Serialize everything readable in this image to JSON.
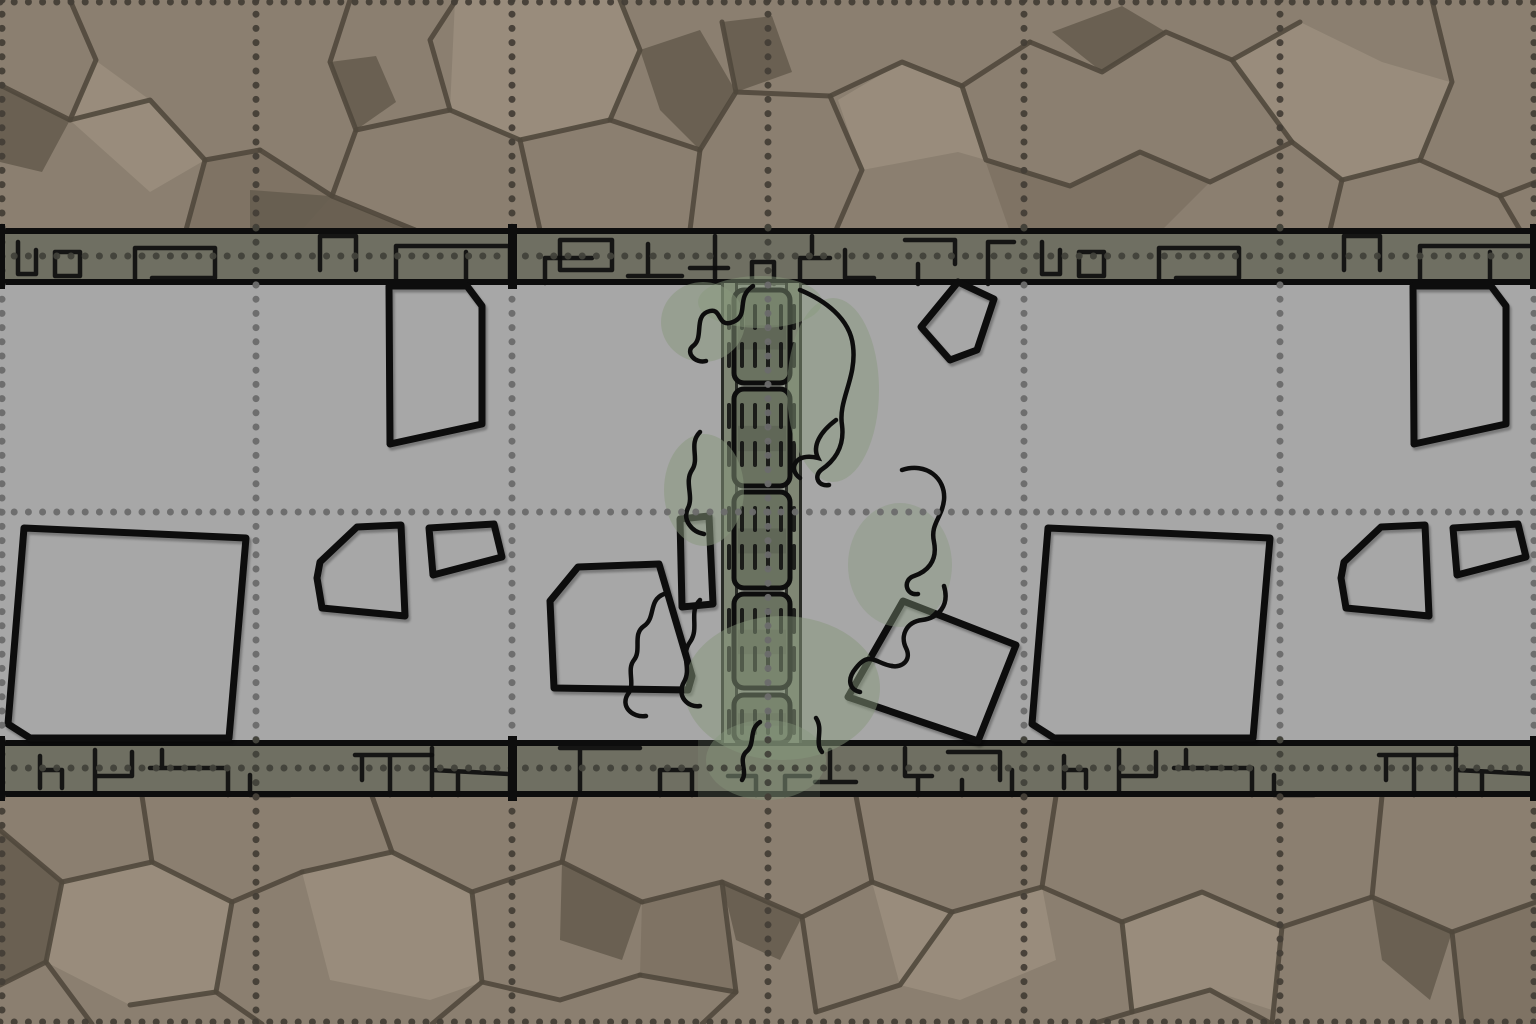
{
  "scene": {
    "width": 1536,
    "height": 1024,
    "module_width": 1024,
    "module_offsets": [
      0,
      1024
    ],
    "colors": {
      "floor": "#a7a7a7",
      "rock_base": "#8b7f70",
      "rock_light": "#9a8e7d",
      "rock_mid": "#7d7263",
      "rock_dark": "#665d4f",
      "crack": "#50483c",
      "wall_fill": "#6f6f62",
      "ink": "#0d0d0d",
      "grid_rock": "#453f37",
      "grid_wall": "#42423a",
      "grid_floor": "#6c6c6c",
      "bridge_rail": "#7f8674",
      "bridge_deck": "#6a7260",
      "bridge_deck_dark": "#5a6152",
      "moss": "#87987c"
    },
    "layout": {
      "rock_top": {
        "y": 0,
        "h": 232
      },
      "rock_bottom": {
        "y": 794,
        "h": 230
      },
      "floor": {
        "y": 285,
        "h": 455
      },
      "wall_top": {
        "y": 228,
        "h": 57
      },
      "wall_bottom": {
        "y": 740,
        "h": 57
      },
      "wall_border_h": 6
    },
    "grid": {
      "cell": 256,
      "dot_step": 14.2,
      "dot_size": 7,
      "v_lines": [
        2,
        256,
        512,
        768,
        1024,
        1280,
        1534
      ],
      "h_lines": [
        2,
        256,
        512,
        768,
        1022
      ]
    },
    "seams": {
      "wall_bars_x": [
        0,
        508,
        1530
      ],
      "bar_w": [
        5,
        9,
        6
      ]
    },
    "rock_top_band": {
      "patches": [
        {
          "fill": "rock_light",
          "pts": "95,60 150,100 205,160 150,192 72,122"
        },
        {
          "fill": "rock_light",
          "pts": "455,0 450,110 520,140 610,120 640,50 622,0"
        },
        {
          "fill": "rock_light",
          "pts": "838,100 862,170 958,152 986,160 962,86 902,62"
        },
        {
          "fill": "rock_light",
          "pts": "1232,60 1300,22 1382,62 1450,82 1420,160 1342,180 1292,142"
        },
        {
          "fill": "rock_dark",
          "pts": "0,85 70,120 42,172 0,162"
        },
        {
          "fill": "rock_dark",
          "pts": "330,62 356,130 396,102 376,56"
        },
        {
          "fill": "rock_dark",
          "pts": "722,22 736,92 792,72 772,16"
        },
        {
          "fill": "rock_dark",
          "pts": "1052,32 1102,72 1166,32 1122,6"
        },
        {
          "fill": "rock_mid",
          "pts": "205,160 260,152 332,196 300,232 186,232"
        },
        {
          "fill": "rock_mid",
          "pts": "985,160 1070,186 1140,152 1210,182 1160,232 1010,232"
        },
        {
          "fill": "rock_dark",
          "pts": "640,50 700,30 735,90 700,150 660,110"
        },
        {
          "fill": "rock_dark",
          "pts": "250,190 330,196 415,232 250,232"
        }
      ],
      "cracks": [
        "M0,85 L70,120 L150,100 L205,160 L260,150",
        "M70,0 L96,60 L70,120",
        "M205,160 L186,230",
        "M260,150 L332,196 L415,230",
        "M332,196 L356,130 L330,62 L350,0",
        "M356,130 L450,110 L520,140 L610,120 L700,150",
        "M450,110 L430,40 L456,0",
        "M520,140 L540,230",
        "M610,120 L640,50 L620,0",
        "M700,150 L736,92 L722,22",
        "M700,150 L690,230",
        "M736,92 L830,96 L902,62 L962,86 L1030,42",
        "M830,96 L862,170 L836,230",
        "M962,86 L986,160 L1070,186 L1140,152 L1210,182 L1292,142",
        "M1030,42 L1102,72 L1166,32 L1232,60 L1300,22",
        "M1292,142 L1342,180 L1420,160 L1500,196 L1536,182",
        "M1420,160 L1452,82 L1432,0",
        "M1342,180 L1330,230",
        "M1500,196 L1520,230",
        "M1232,60 L1292,142"
      ]
    },
    "rock_bottom_band": {
      "patches": [
        {
          "fill": "rock_light",
          "pts": "62,882 152,862 232,902 216,992 130,1005 46,962"
        },
        {
          "fill": "rock_light",
          "pts": "392,852 472,892 482,982 430,1000 330,980 302,872"
        },
        {
          "fill": "rock_light",
          "pts": "872,882 952,912 1042,887 1056,960 960,1000 900,985"
        },
        {
          "fill": "rock_light",
          "pts": "1202,892 1282,927 1272,1010 1210,990 1132,1012 1122,922"
        },
        {
          "fill": "rock_dark",
          "pts": "0,830 62,882 46,962 0,985"
        },
        {
          "fill": "rock_dark",
          "pts": "562,862 642,902 622,960 560,940"
        },
        {
          "fill": "rock_dark",
          "pts": "722,882 802,917 780,960 736,940"
        },
        {
          "fill": "rock_dark",
          "pts": "1372,897 1452,932 1430,1000 1382,960"
        },
        {
          "fill": "rock_mid",
          "pts": "642,902 722,882 736,992 640,975"
        },
        {
          "fill": "rock_mid",
          "pts": "1452,932 1536,902 1536,1024 1462,1024"
        }
      ],
      "cracks": [
        "M0,830 L62,882 L46,962 L92,1024",
        "M62,882 L152,862 L232,902 L302,872",
        "M152,862 L142,796",
        "M232,902 L216,992 L262,1024",
        "M302,872 L392,852 L472,892 L562,862 L642,902",
        "M392,852 L372,796",
        "M472,892 L482,982 L432,1024",
        "M562,862 L576,796",
        "M642,902 L722,882 L802,917 L872,882 L952,912",
        "M722,882 L736,992 L702,1024",
        "M802,917 L816,1012",
        "M872,882 L856,796",
        "M952,912 L1042,887 L1122,922 L1202,892 L1282,927 L1372,897 L1452,932 L1536,902",
        "M1042,887 L1056,796",
        "M1122,922 L1132,1012 L1092,1024",
        "M1282,927 L1272,1024",
        "M1372,897 L1382,796",
        "M1452,932 L1462,1024",
        "M46,962 L0,985",
        "M216,992 L130,1005",
        "M482,982 L560,1000 L640,975",
        "M736,992 L640,975",
        "M816,1012 L900,985 L952,912",
        "M1132,1012 L1210,990 L1272,1024"
      ]
    },
    "wall_marks_top": [
      "M18,14 L18,46 L36,46 L36,22",
      "M55,24 L80,24 L80,48 L55,48 Z",
      "M135,20 L135,52 M135,20 L215,20 L215,50 L152,50",
      "M320,42 L320,8 L356,8 L356,42",
      "M396,18 L396,55 M396,18 L510,18 L510,55 M466,24 L466,55",
      "M545,30 L545,55 M545,30 L592,30",
      "M560,12 L612,12 L612,42 L560,42 Z",
      "M648,16 L648,48 M628,48 L682,48",
      "M715,8 L715,50",
      "M690,40 L728,40",
      "M752,56 L752,34 L774,34 L774,56",
      "M800,56 L800,30 L830,30",
      "M812,8 L812,26",
      "M845,22 L845,50 L874,50",
      "M905,12 L955,12 L955,36 M918,36 L918,56",
      "M988,14 L988,56 M988,14 L1014,14"
    ],
    "wall_marks_bottom": [
      "M40,16 L40,48 M40,30 L62,30 L62,48",
      "M95,10 L95,52 M95,36 L132,36 L132,12",
      "M150,28 L228,28 L228,55 M162,28 L162,10",
      "M250,35 L250,55 L290,55",
      "M355,15 L432,15 M390,15 L390,55 M362,15 L362,40",
      "M432,8 L432,55 M432,30 L510,34 L510,55 M458,34 L458,55",
      "M560,8 L640,8 M580,8 L580,50",
      "M660,55 L660,30 L692,30 L692,55",
      "M728,36 L756,36 L756,55 M785,55 L785,36 L810,36",
      "M830,10 L830,42 M815,42 L856,42",
      "M905,8 L905,36 L932,36 M918,36 L918,55",
      "M948,12 L1000,12 L1000,40 M962,40 L962,55",
      "M1012,30 L1012,55"
    ],
    "debris_module": [
      "M24,528 L246,538 L229,738 L30,738 L8,724 Z",
      "M320,562 L357,527 L401,525 L405,616 L322,608 L317,578 Z",
      "M429,528 L494,524 L502,557 L433,575 Z",
      "M389,286 L467,286 L482,306 L482,424 L390,444 Z",
      "M578,567 L659,564 L692,676 L688,690 L554,688 L550,601 Z",
      "M680,519 L709,516 L713,604 L682,607 Z",
      "M903,601 L1016,645 L978,741 L848,697 Z",
      "M958,282 L994,299 L977,350 L950,360 L921,327 Z"
    ],
    "bridge": {
      "rail_left_x": 721,
      "rail_right_x": 785,
      "rail_w": 17,
      "deck_x": 734,
      "deck_w": 56,
      "top": 283,
      "bottom": 743,
      "segments": [
        [
          290,
          93
        ],
        [
          389,
          97
        ],
        [
          492,
          96
        ],
        [
          594,
          94
        ],
        [
          695,
          48
        ]
      ],
      "dash_cols": [
        727,
        740,
        753,
        766,
        779,
        792
      ],
      "dash_rows": [
        14,
        52
      ],
      "dash_w": 4,
      "dash_h": 26,
      "wall_tint": {
        "x": 698,
        "y": 740,
        "w": 122,
        "h": 57
      }
    },
    "moss": {
      "blobs": [
        [
          760,
          302,
          62,
          26,
          0.45
        ],
        [
          703,
          322,
          42,
          40,
          0.5
        ],
        [
          833,
          390,
          46,
          92,
          0.45
        ],
        [
          704,
          490,
          40,
          56,
          0.5
        ],
        [
          900,
          565,
          52,
          62,
          0.4
        ],
        [
          782,
          688,
          98,
          72,
          0.5
        ],
        [
          766,
          760,
          60,
          40,
          0.4
        ]
      ],
      "squiggles": [
        "M753,286 C735,298 750,315 733,322 C716,329 723,305 707,312 C694,318 704,338 693,346 C685,352 695,364 706,361",
        "M800,290 C824,300 850,318 853,346 C857,378 838,400 842,425 C845,448 833,462 821,470 C813,477 819,487 829,485",
        "M836,420 C820,432 812,446 818,458 C794,452 788,470 800,478",
        "M902,470 C926,462 946,478 944,500 C942,518 930,524 934,542 C938,562 926,572 914,576 C902,580 906,596 918,594",
        "M700,432 C688,444 700,458 692,470 C684,482 694,496 688,508 C682,520 692,532 704,534",
        "M664,594 C648,600 656,618 644,626 C632,634 642,650 634,660 C626,670 636,684 628,694 C620,706 632,718 646,716",
        "M700,600 C688,612 700,628 690,642 C680,656 692,668 684,682 C676,696 688,708 700,706",
        "M944,586 C950,606 938,618 922,620 C906,622 900,636 906,648 C912,660 902,668 892,666",
        "M892,666 C876,664 870,650 856,668 C846,680 850,690 860,692",
        "M760,722 C748,730 756,744 746,752 C738,760 748,772 742,780",
        "M816,718 C824,730 814,742 822,752"
      ]
    }
  }
}
